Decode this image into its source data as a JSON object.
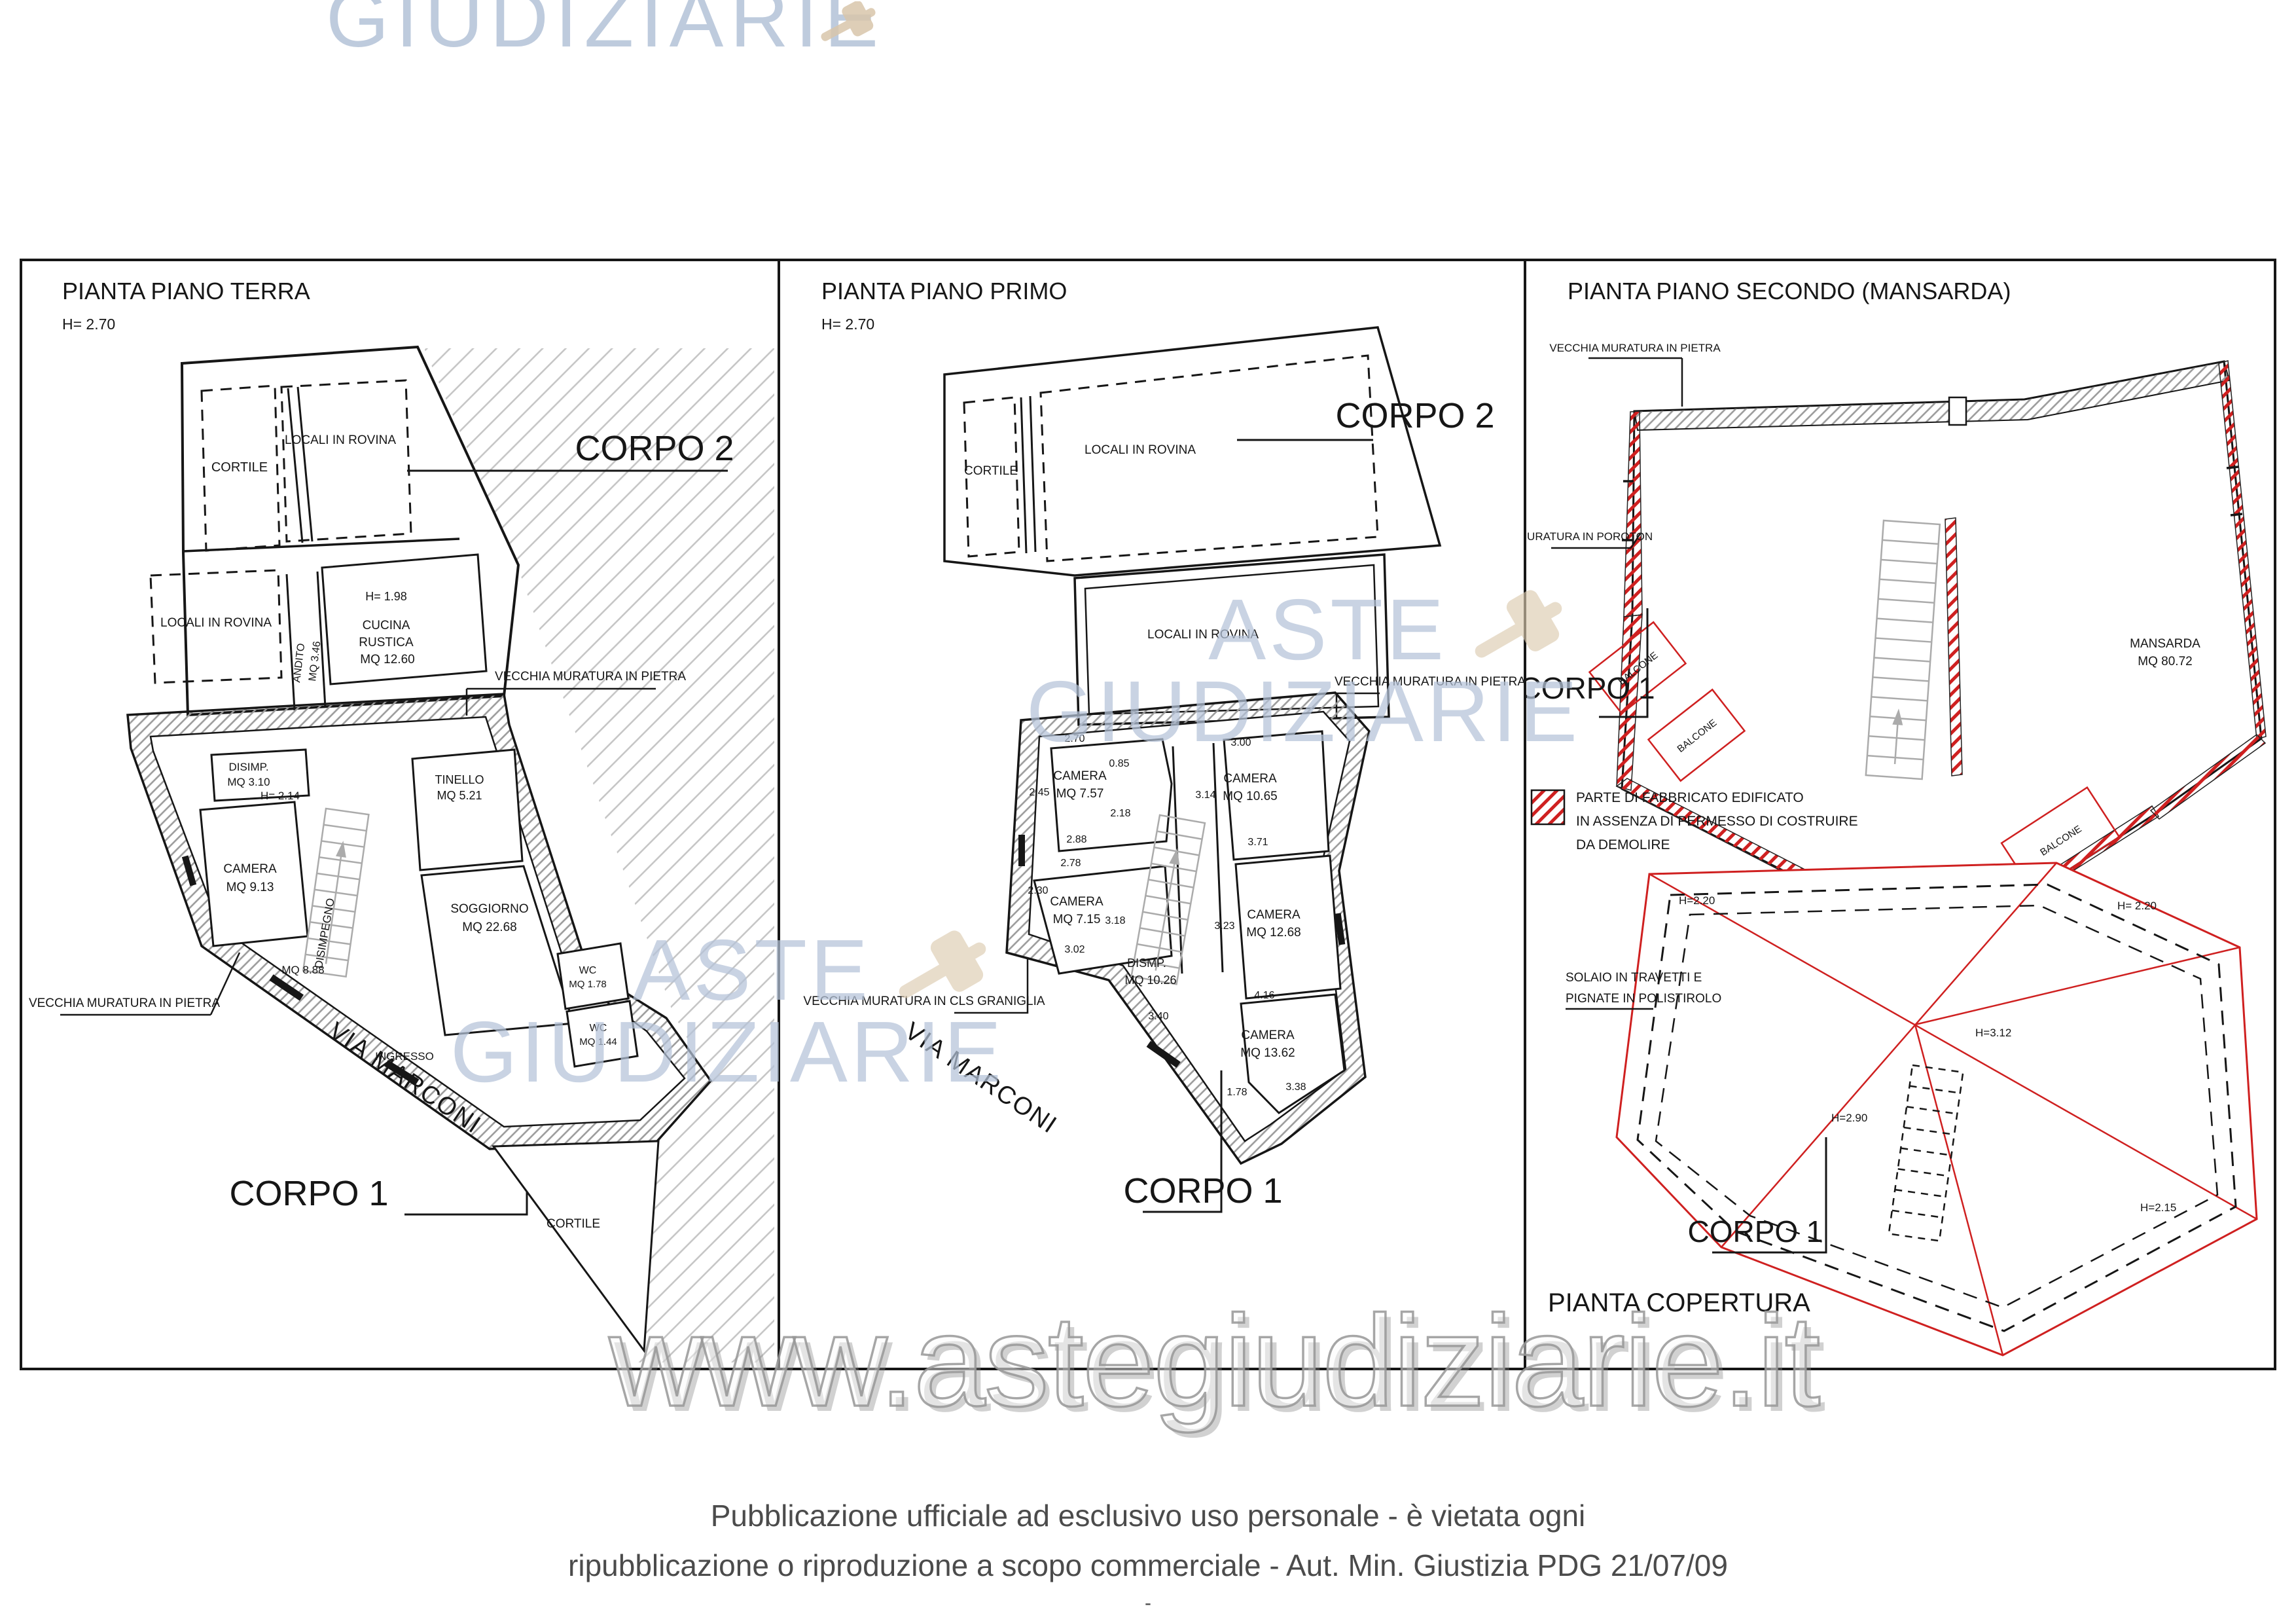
{
  "watermarks": {
    "top_partial": "GIUDIZIARIE",
    "aste": "ASTE",
    "giudiziarie": "GIUDIZIARIE",
    "site": "www.astegiudiziarie.it"
  },
  "footer": {
    "line1": "Pubblicazione ufficiale ad esclusivo uso personale - è vietata ogni",
    "line2": "ripubblicazione o riproduzione a scopo commerciale - Aut. Min. Giustizia PDG 21/07/09",
    "line3": "-"
  },
  "panel1": {
    "title": "PIANTA PIANO TERRA",
    "height_note": "H= 2.70",
    "corpo2_label": "CORPO 2",
    "corpo1_label": "CORPO 1",
    "cortile_top": "CORTILE",
    "locali_top": "LOCALI IN ROVINA",
    "locali_bottom": "LOCALI IN ROVINA",
    "andito_l1": "ANDITO",
    "andito_l2": "MQ 3.46",
    "cucina_h": "H= 1.98",
    "cucina_l1": "CUCINA",
    "cucina_l2": "RUSTICA",
    "cucina_l3": "MQ 12.60",
    "muratura_right": "VECCHIA MURATURA IN PIETRA",
    "muratura_left": "VECCHIA MURATURA IN PIETRA",
    "disimp_l1": "DISIMP.",
    "disimp_l2": "MQ 3.10",
    "disimp_h": "H= 2.14",
    "tinello_l1": "TINELLO",
    "tinello_l2": "MQ 5.21",
    "camera_l1": "CAMERA",
    "camera_l2": "MQ 9.13",
    "disimpegno": "DISIMPEGNO",
    "mq888": "MQ 8.88",
    "soggiorno_l1": "SOGGIORNO",
    "soggiorno_l2": "MQ 22.68",
    "wc1_l1": "WC",
    "wc1_l2": "MQ 1.78",
    "wc2_l1": "WC",
    "wc2_l2": "MQ 1.44",
    "ingresso": "INGRESSO",
    "via_marconi": "VIA MARCONI",
    "cortile_bottom": "CORTILE"
  },
  "panel2": {
    "title": "PIANTA PIANO PRIMO",
    "height_note": "H= 2.70",
    "corpo2_label": "CORPO 2",
    "corpo1_label": "CORPO 1",
    "cortile": "CORTILE",
    "locali_top": "LOCALI IN ROVINA",
    "locali_mid": "LOCALI IN ROVINA",
    "muratura_pietra": "VECCHIA MURATURA IN PIETRA",
    "muratura_cls": "VECCHIA MURATURA IN CLS GRANIGLIA",
    "via_marconi": "VIA MARCONI",
    "camera757_l1": "CAMERA",
    "camera757_l2": "MQ 7.57",
    "camera715_l1": "CAMERA",
    "camera715_l2": "MQ 7.15",
    "camera1065_l1": "CAMERA",
    "camera1065_l2": "MQ 10.65",
    "camera1268_l1": "CAMERA",
    "camera1268_l2": "MQ 12.68",
    "camera1362_l1": "CAMERA",
    "camera1362_l2": "MQ 13.62",
    "dismp_l1": "DISMP.",
    "dismp_l2": "MQ 10.26",
    "dims": {
      "d270": "2.70",
      "d085": "0.85",
      "d245": "2.45",
      "d218": "2.18",
      "d288": "2.88",
      "d278": "2.78",
      "d230": "2.30",
      "d318": "3.18",
      "d302": "3.02",
      "d300": "3.00",
      "d314": "3.14",
      "d371": "3.71",
      "d323": "3.23",
      "d340": "3.40",
      "d416": "4.16",
      "d178": "1.78",
      "d338": "3.38"
    }
  },
  "panel3": {
    "title": "PIANTA PIANO SECONDO (MANSARDA)",
    "muratura_pietra": "VECCHIA MURATURA IN PIETRA",
    "muratura_poroton": "MURATURA IN POROTON",
    "corpo1_label": "CORPO 1",
    "mansarda_l1": "MANSARDA",
    "mansarda_l2": "MQ 80.72",
    "balcone1": "BALCONE",
    "balcone2": "BALCONE",
    "balcone3": "BALCONE",
    "legend_l1": "PARTE DI FABBRICATO EDIFICATO",
    "legend_l2": "IN ASSENZA DI PERMESSO DI COSTRUIRE",
    "legend_l3": "DA DEMOLIRE",
    "solaio_l1": "SOLAIO IN TRAVETTI E",
    "solaio_l2": "PIGNATE IN POLISTIROLO",
    "roof_h_tl": "H=2.20",
    "roof_h_tr": "H= 2.20",
    "roof_h_c": "H=3.12",
    "roof_h_bl": "H=2.90",
    "roof_h_br": "H=2.15",
    "corpo1_roof": "CORPO 1",
    "pianta_copertura": "PIANTA COPERTURA"
  }
}
